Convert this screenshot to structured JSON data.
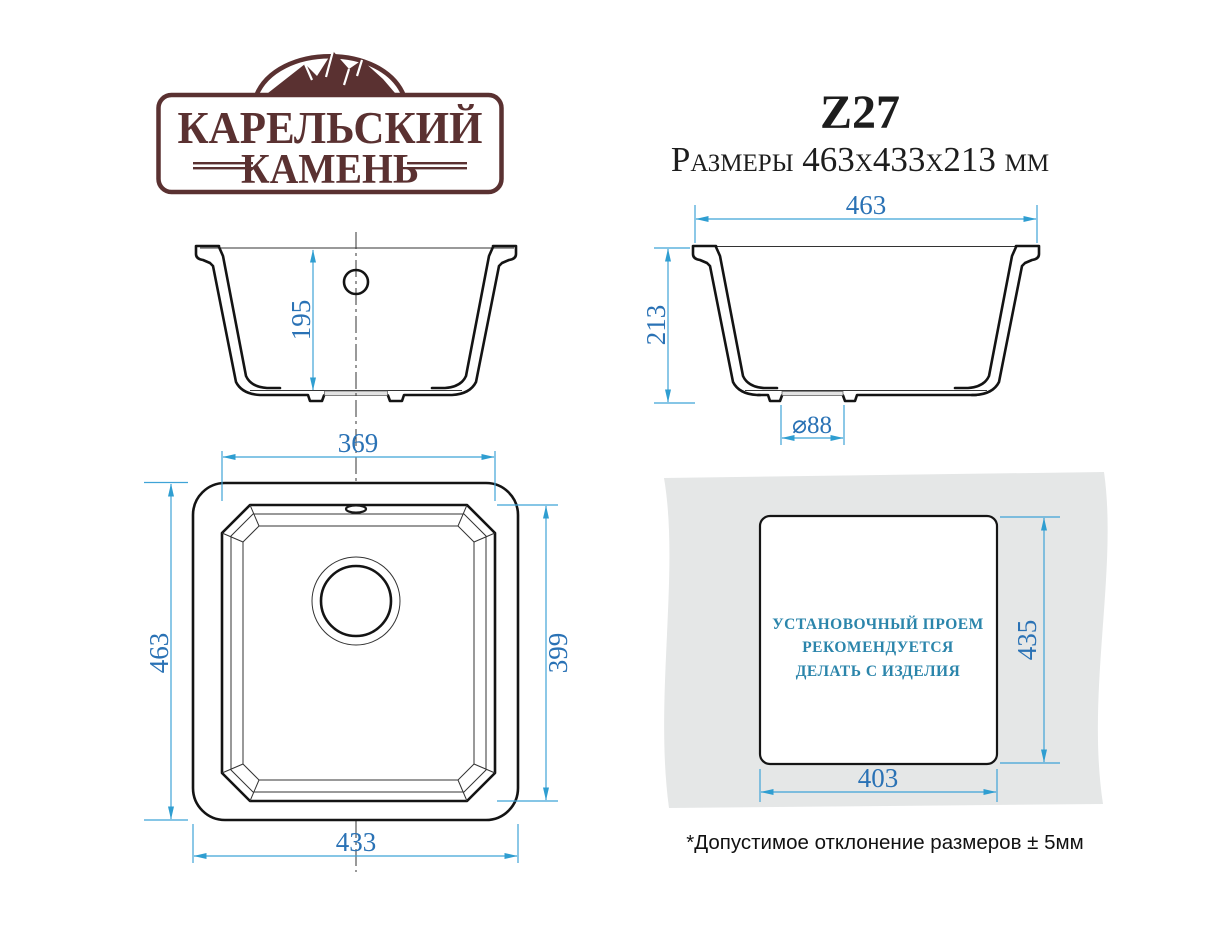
{
  "logo": {
    "brand_line1": "КАРЕЛЬСКИЙ",
    "brand_line2": "КАМЕНЬ"
  },
  "header": {
    "model": "Z27",
    "size_line": "Размеры 463x433x213 мм"
  },
  "front_section": {
    "bowl_depth": "195"
  },
  "side_section": {
    "overall_width": "463",
    "overall_height": "213",
    "drain_diameter": "⌀88"
  },
  "plan_view": {
    "bowl_width": "369",
    "overall_length": "463",
    "bowl_length": "399",
    "overall_width": "433"
  },
  "cutout_view": {
    "note_line1": "УСТАНОВОЧНЫЙ ПРОЕМ",
    "note_line2": "РЕКОМЕНДУЕТСЯ",
    "note_line3": "ДЕЛАТЬ С ИЗДЕЛИЯ",
    "cutout_height": "435",
    "cutout_width": "403"
  },
  "footnote": "*Допустимое отклонение размеров ± 5мм",
  "colors": {
    "outline": "#141414",
    "dimension_line": "#3fa3d7",
    "dimension_text": "#2a72b5",
    "logo_brown": "#5a3131",
    "cutout_note_text": "#2b85ab",
    "countertop_gray": "#e5e7e7"
  }
}
